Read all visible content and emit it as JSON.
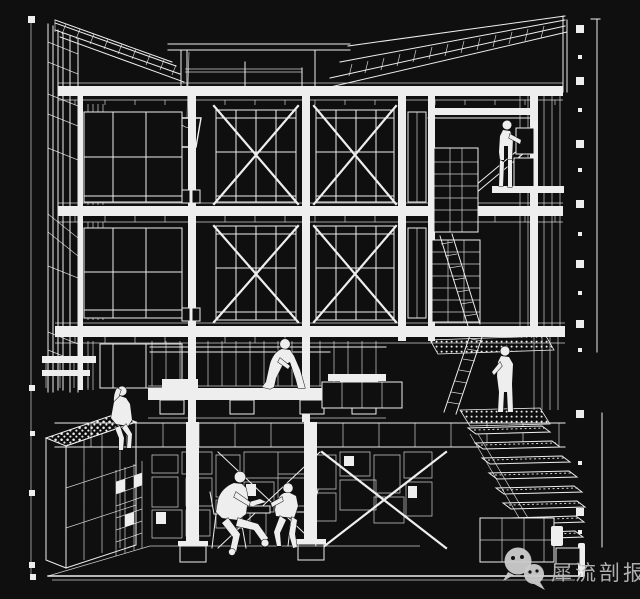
{
  "canvas": {
    "width": 640,
    "height": 599
  },
  "colors": {
    "background": "#0f0f0f",
    "line": "#eeeeee",
    "watermark_text": "#bdbdbd",
    "watermark_icon": "#cccccc"
  },
  "drawing": {
    "type": "architectural-sectional-perspective",
    "style": "white wireframe on black",
    "floors": 3,
    "elements": [
      "mono-pitch-roof-rafters-left",
      "mono-pitch-roof-rafters-right",
      "clerestory-beam",
      "hanging-bucket-pendant",
      "cross-braced-timber-frame",
      "gridded-window-walls",
      "right-wall-stud-screen",
      "storage-shelves",
      "leaning-ladders",
      "mid-level-sitting-platform",
      "gravel-roof-planter-box",
      "basement-meeting-space",
      "stepped-gravel-stair",
      "left-elevation-ruler",
      "right-elevation-ruler",
      "ground-baseline"
    ],
    "figures": [
      {
        "name": "figure-on-upper-mezzanine"
      },
      {
        "name": "figure-seated-on-platform"
      },
      {
        "name": "figure-seated-edge-legs-dangling"
      },
      {
        "name": "figure-standing-at-stair-landing"
      },
      {
        "name": "figure-seated-man-left"
      },
      {
        "name": "figure-seated-man-right"
      }
    ]
  },
  "watermark": {
    "icon": "wechat-icon",
    "text": "犀流剖报"
  }
}
